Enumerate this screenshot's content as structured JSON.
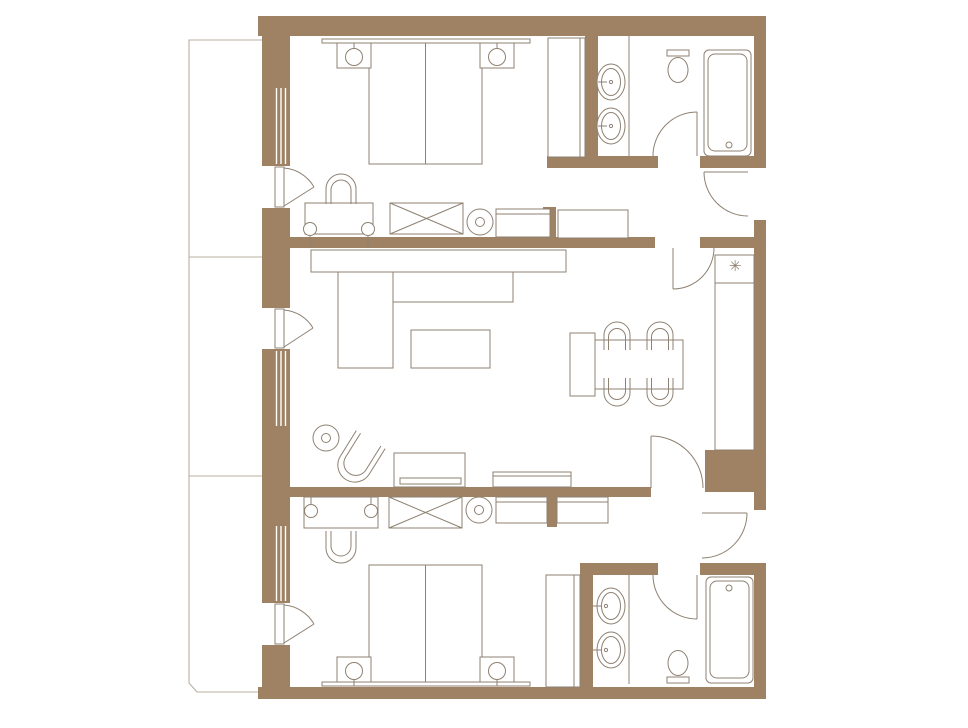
{
  "colors": {
    "background": "#ffffff",
    "wall": "#9e8263",
    "window_slit": "#ffffff",
    "furniture_line": "#8e8172",
    "fixture_fill": "#ffffff",
    "balcony_line": "#b9b0a2"
  },
  "symbols": {
    "minibar_snowflake": "✳"
  },
  "plan": {
    "type": "hotel-two-bedroom-suite-floor-plan",
    "rooms": [
      "bedroom-top",
      "bathroom-top",
      "corridor-top",
      "living-dining",
      "corridor-bottom",
      "bedroom-bottom",
      "bathroom-bottom",
      "balcony"
    ],
    "fixtures": {
      "bedroom_top": [
        "double-bed",
        "nightstand-left",
        "table-lamp-left",
        "nightstand-right",
        "table-lamp-right",
        "desk",
        "arch-chair",
        "luggage-rack",
        "stool",
        "console",
        "closet"
      ],
      "bathroom_top": [
        "sink-upper",
        "sink-lower",
        "toilet",
        "bathtub",
        "swing-door"
      ],
      "corridor_top": [
        "closet-row",
        "entry-door",
        "inner-door",
        "minibar",
        "wardrobe-column"
      ],
      "living_dining": [
        "sofa-back",
        "chaise",
        "sofa-seat",
        "coffee-table",
        "armchair",
        "side-table",
        "tv-console",
        "low-console",
        "dining-bench",
        "dining-table",
        "dining-chair-1",
        "dining-chair-2",
        "dining-chair-3",
        "dining-chair-4"
      ],
      "corridor_bottom": [
        "dresser",
        "entry-door",
        "inner-door"
      ],
      "bedroom_bottom": [
        "double-bed",
        "nightstand-left",
        "table-lamp-left",
        "nightstand-right",
        "table-lamp-right",
        "desk",
        "arch-chair",
        "luggage-rack",
        "stool",
        "console",
        "closet"
      ],
      "bathroom_bottom": [
        "sink-upper",
        "sink-lower",
        "toilet",
        "bathtub",
        "swing-door"
      ],
      "balcony": [
        "divider-upper",
        "divider-lower"
      ]
    }
  }
}
